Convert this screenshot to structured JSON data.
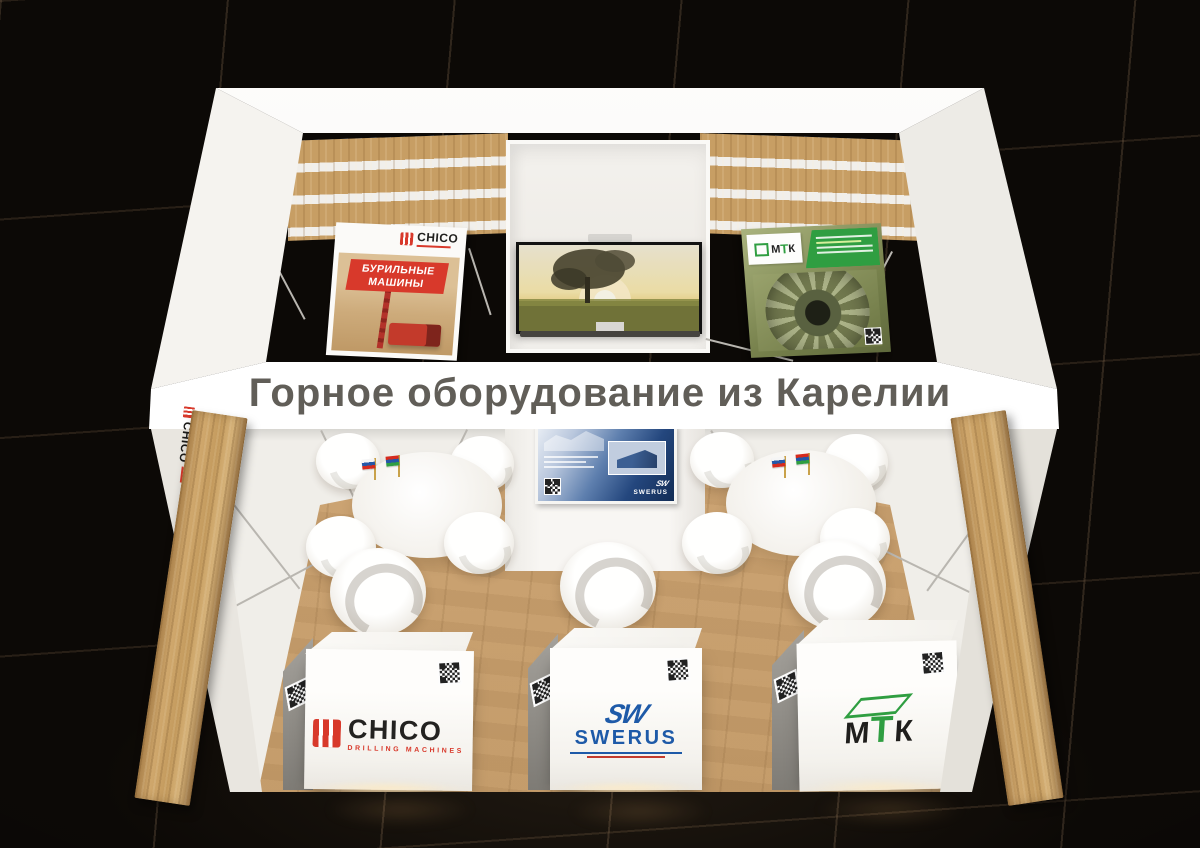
{
  "fascia": {
    "title": "Горное оборудование из Карелии"
  },
  "brands": {
    "chico": {
      "name": "CHICO",
      "sub": "DRILLING MACHINES",
      "banner_line1": "БУРИЛЬНЫЕ",
      "banner_line2": "МАШИНЫ"
    },
    "swerus": {
      "mark": "SW",
      "name": "SWERUS"
    },
    "mtk": {
      "letters": [
        "М",
        "Т",
        "К"
      ]
    }
  },
  "colors": {
    "chico_red": "#d8392b",
    "swerus_blue": "#1e5aa8",
    "mtk_green": "#2f9e41",
    "booth_white": "#f5f3ef",
    "wood": "#c79e64",
    "floor_tile_black": "#0c0906",
    "title_gray": "#615e58"
  },
  "icons": {
    "qr": "qr-code",
    "flags": [
      "flag-russia",
      "flag-karelia"
    ]
  }
}
